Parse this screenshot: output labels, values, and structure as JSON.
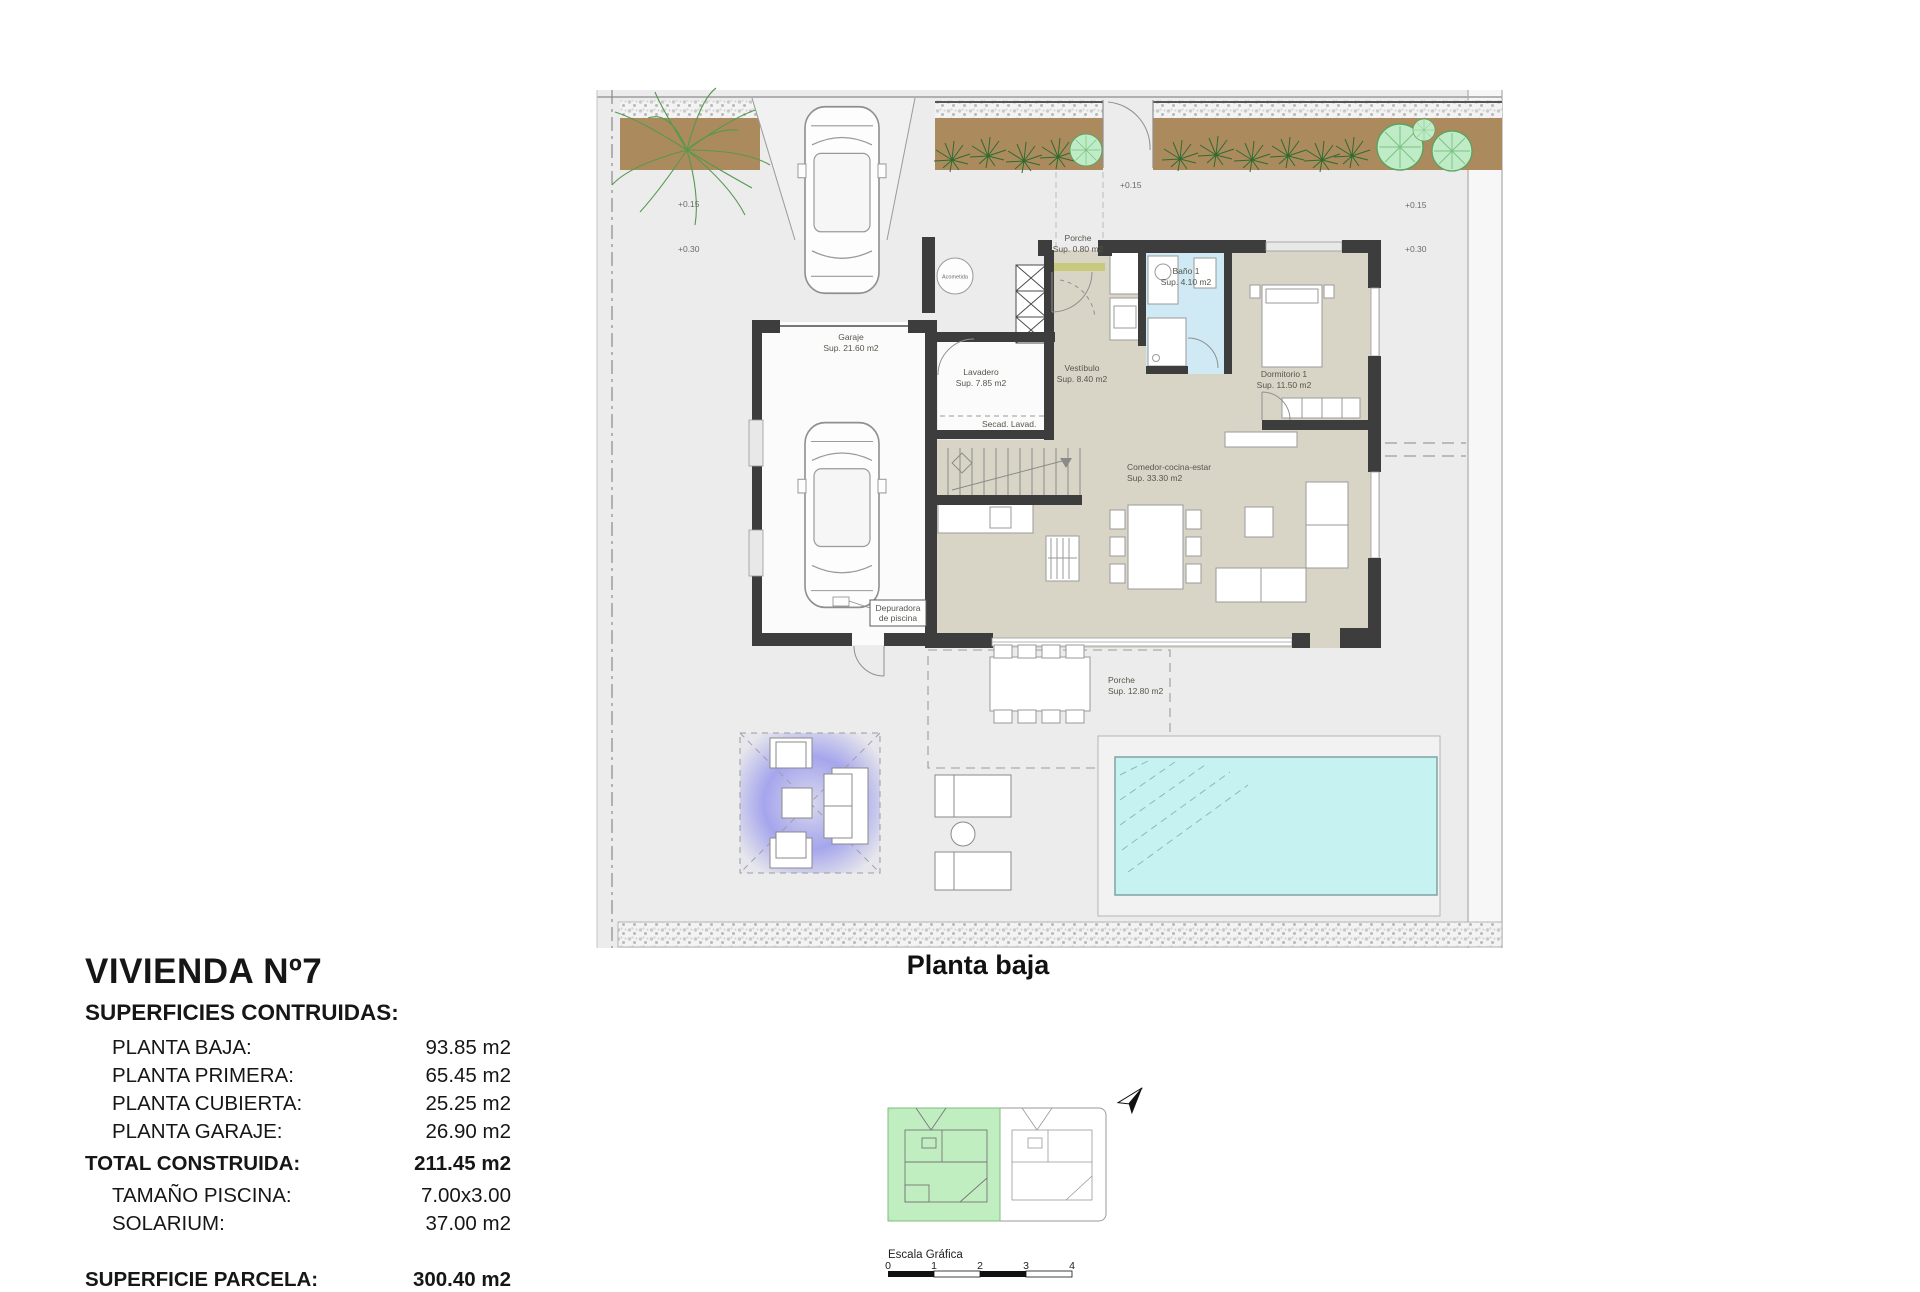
{
  "title_block": {
    "title": "VIVIENDA Nº7",
    "subtitle": "SUPERFICIES CONTRUIDAS:",
    "rows": [
      {
        "label": "PLANTA BAJA:",
        "value": "93.85 m2"
      },
      {
        "label": "PLANTA PRIMERA:",
        "value": "65.45 m2"
      },
      {
        "label": "PLANTA CUBIERTA:",
        "value": "25.25 m2"
      },
      {
        "label": "PLANTA GARAJE:",
        "value": "26.90 m2"
      }
    ],
    "total": {
      "label": "TOTAL CONSTRUIDA:",
      "value": "211.45 m2"
    },
    "extra_rows": [
      {
        "label": "TAMAÑO PISCINA:",
        "value": "7.00x3.00"
      },
      {
        "label": "SOLARIUM:",
        "value": "37.00 m2"
      }
    ],
    "parcel": {
      "label": "SUPERFICIE PARCELA:",
      "value": "300.40 m2"
    }
  },
  "plan": {
    "caption": "Planta baja",
    "rooms": {
      "porche_top": {
        "name": "Porche",
        "sup": "Sup. 0.80 m2"
      },
      "bano": {
        "name": "Baño 1",
        "sup": "Sup. 4.10 m2"
      },
      "dormitorio": {
        "name": "Dormitorio 1",
        "sup": "Sup. 11.50 m2"
      },
      "garaje": {
        "name": "Garaje",
        "sup": "Sup. 21.60 m2"
      },
      "lavadero": {
        "name": "Lavadero",
        "sup": "Sup. 7.85 m2"
      },
      "vestibulo": {
        "name": "Vestíbulo",
        "sup": "Sup. 8.40 m2"
      },
      "secadero": {
        "name": "Secad.  Lavad."
      },
      "comedor": {
        "name": "Comedor-cocina-estar",
        "sup": "Sup. 33.30 m2"
      },
      "porche_inferior": {
        "name": "Porche",
        "sup": "Sup. 12.80 m2"
      },
      "depuradora_line1": "Depuradora",
      "depuradora_line2": "de piscina",
      "acometida": "Acometida"
    },
    "levels": {
      "left_upper": "+0.15",
      "left_lower": "+0.30",
      "center": "+0.15",
      "right_upper": "+0.15",
      "right_lower": "+0.30"
    }
  },
  "key_plan": {
    "scale_label": "Escala Gráfica",
    "ticks": [
      "0",
      "1",
      "2",
      "3",
      "4"
    ]
  },
  "colors": {
    "wall": "#3d3d3d",
    "floor_beige": "#d9d5c6",
    "bath_blue": "#cfeaf4",
    "pool_cyan": "#c6f3f1",
    "planter_brown": "#ab8a5e",
    "keyplan_green": "#b9ecba",
    "pergola_blue": "#6b6bee",
    "site_grey": "#ececec"
  }
}
